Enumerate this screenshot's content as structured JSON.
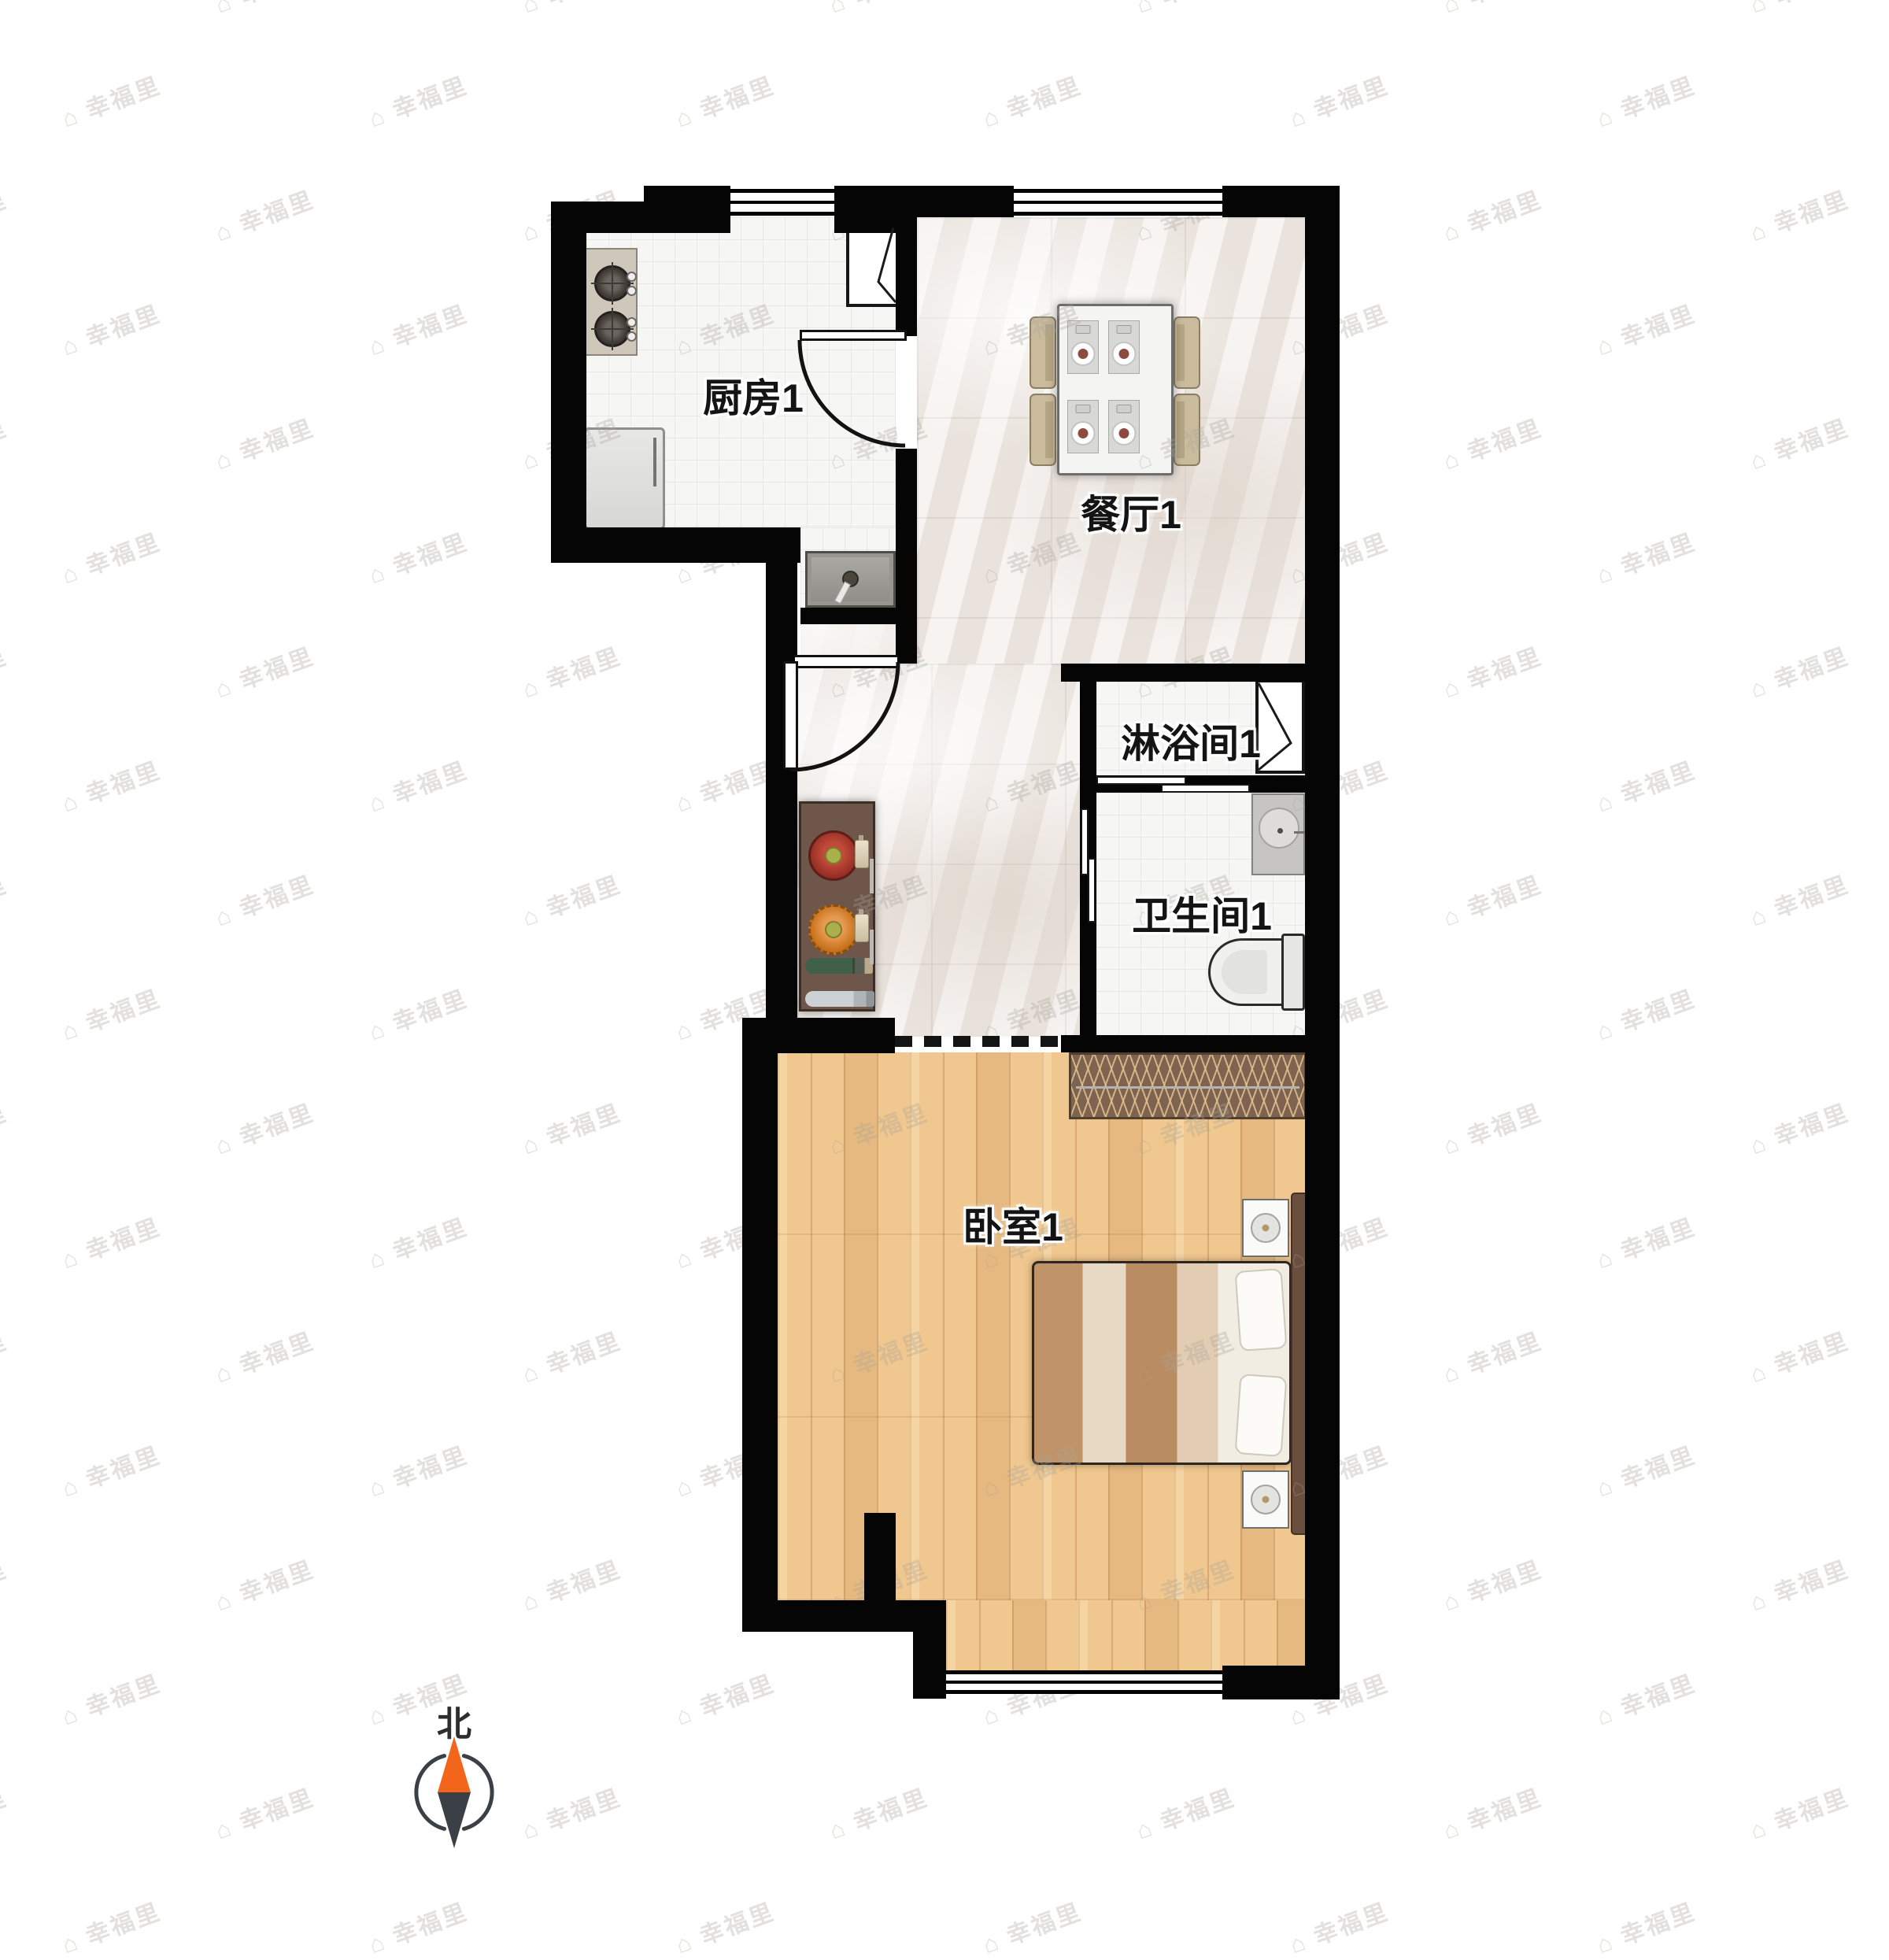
{
  "floorplan": {
    "rooms": {
      "kitchen": {
        "label": "厨房1"
      },
      "dining": {
        "label": "餐厅1"
      },
      "shower": {
        "label": "淋浴间1"
      },
      "bathroom": {
        "label": "卫生间1"
      },
      "bedroom": {
        "label": "卧室1"
      }
    },
    "compass": {
      "north_label": "北",
      "needle_north_color": "#f2651a",
      "needle_south_color": "#3a4046"
    },
    "colors": {
      "wall": "#050505",
      "wood_floor": "#f0c78e",
      "marble_floor": "#f0ebe7",
      "tile_floor": "#f6f6f5"
    }
  },
  "watermark": {
    "text": "幸福里",
    "icon": "⌂"
  }
}
